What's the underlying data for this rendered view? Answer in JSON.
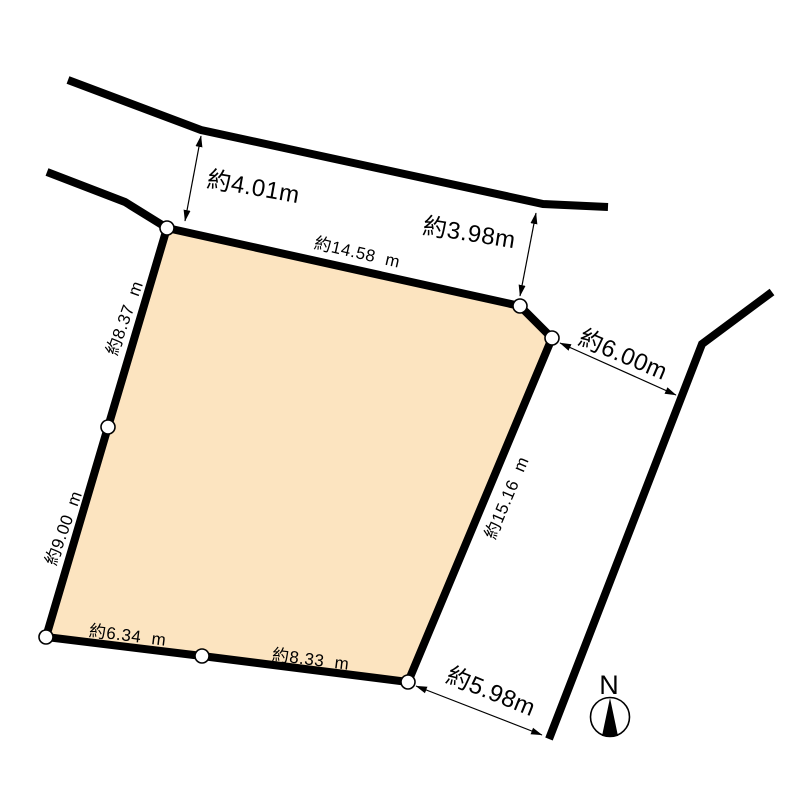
{
  "figure": {
    "type": "land-plot-survey-diagram",
    "background": "#ffffff"
  },
  "colors": {
    "parcel_fill": "#FCE4C0",
    "line": "#000000",
    "vertex_fill": "#ffffff"
  },
  "parcel": {
    "edge_labels": {
      "top": "約14.58  m",
      "right": "約15.16  m",
      "bottom_right": "約8.33  m",
      "bottom_left": "約6.34  m",
      "left_lower": "約9.00  m",
      "left_upper": "約8.37  m"
    }
  },
  "dimensions": {
    "top_road_width_left": "約4.01m",
    "top_road_width_right": "約3.98m",
    "right_road_offset_upper": "約6.00m",
    "right_road_offset_lower": "約5.98m"
  },
  "compass": {
    "north_label": "N"
  }
}
